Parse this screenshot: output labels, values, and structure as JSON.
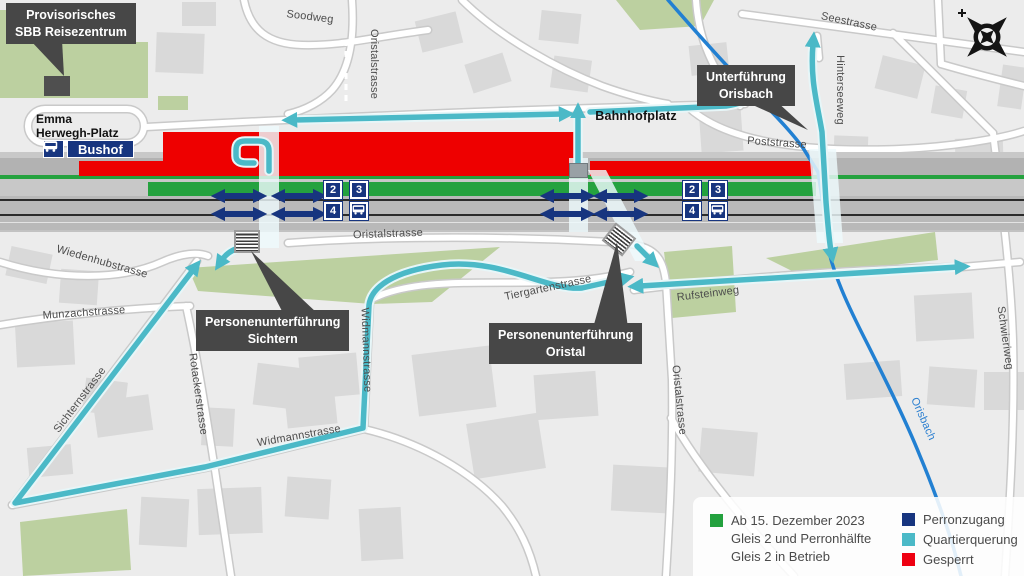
{
  "callouts": {
    "reisezentrum": {
      "line1": "Provisorisches",
      "line2": "SBB Reisezentrum"
    },
    "orisbach": {
      "line1": "Unterführung",
      "line2": "Orisbach"
    },
    "sichtern": {
      "line1": "Personenunterführung",
      "line2": "Sichtern"
    },
    "oristal": {
      "line1": "Personenunterführung",
      "line2": "Oristal"
    }
  },
  "station": {
    "emma_line1": "Emma",
    "emma_line2": "Herwegh-Platz",
    "bushof": "Bushof",
    "bahnhofplatz": "Bahnhofplatz"
  },
  "streets": {
    "soodweg": "Soodweg",
    "oristalstrasse_top": "Oristalstrasse",
    "seestrasse": "Seestrasse",
    "hinterseeweg": "Hinterseeweg",
    "poststrasse": "Poststrasse",
    "wiedenhubstrasse": "Wiedenhubstrasse",
    "munzachstrasse": "Munzachstrasse",
    "sichternstrasse": "Sichternstrasse",
    "rotackerstrasse": "Rotackerstrasse",
    "widmannstrasse_h": "Widmannstrasse",
    "widmannstrasse_v": "Widmannstrasse",
    "tiergartenstrasse": "Tiergartenstrasse",
    "oristalstrasse_mid": "Oristalstrasse",
    "oristalstrasse_v": "Oristalstrasse",
    "rufsteinweg": "Rufsteinweg",
    "schwieriweg": "Schwieriweg",
    "orisbach_river": "Orisbach"
  },
  "platforms": {
    "p2": "2",
    "p3": "3",
    "p4": "4"
  },
  "icons": {
    "bus": "bus-icon",
    "stairs": "stairs-icon",
    "compass": "compass-rose-icon"
  },
  "legend": {
    "item1": {
      "color": "#23a13e",
      "line1": "Ab 15. Dezember 2023",
      "line2": "Gleis 2 und Perronhälfte",
      "line3": "Gleis 2 in Betrieb"
    },
    "item2": {
      "color": "#17357f",
      "label": "Perronzugang"
    },
    "item3": {
      "color": "#4bb9c7",
      "label": "Quartierquerung"
    },
    "item4": {
      "color": "#ee0011",
      "label": "Gesperrt"
    }
  },
  "colors": {
    "gesperrt": "#ee0000",
    "in_betrieb": "#25a23f",
    "perronzugang": "#17357f",
    "quartierquerung": "#4bb9c7",
    "river": "#2280d2"
  }
}
